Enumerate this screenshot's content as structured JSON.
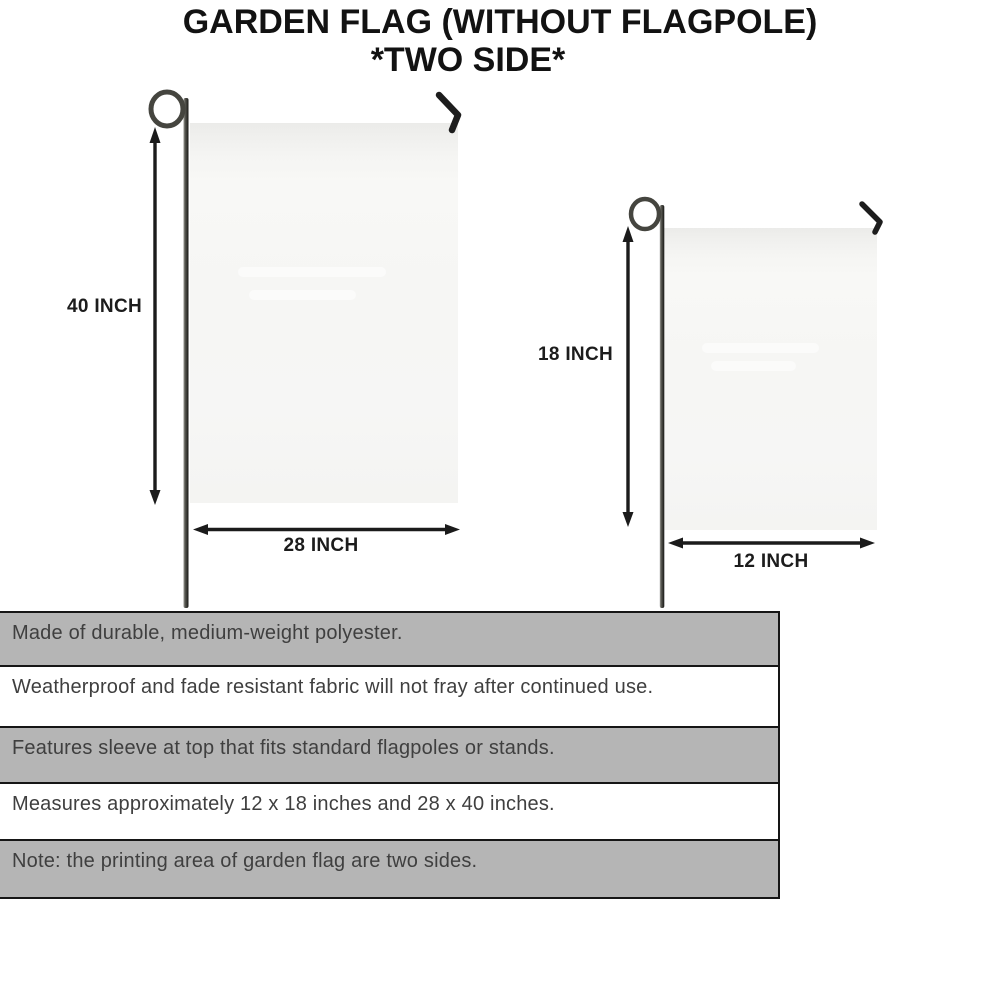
{
  "title": {
    "line1": "GARDEN FLAG (WITHOUT FLAGPOLE)",
    "line2": "*TWO SIDE*"
  },
  "flags": {
    "large": {
      "height_label": "40 INCH",
      "width_label": "28 INCH"
    },
    "small": {
      "height_label": "18 INCH",
      "width_label": "12 INCH"
    }
  },
  "features": {
    "rows": [
      {
        "text": "Made of durable, medium-weight polyester.",
        "shaded": true
      },
      {
        "text": "Weatherproof and fade resistant fabric will not fray after continued use.",
        "shaded": false
      },
      {
        "text": "Features sleeve at top that fits standard flagpoles or stands.",
        "shaded": true
      },
      {
        "text": "Measures approximately 12 x 18 inches and 28 x 40 inches.",
        "shaded": false
      },
      {
        "text": "Note: the printing area of garden flag are two sides.",
        "shaded": true
      }
    ]
  },
  "colors": {
    "background": "#ffffff",
    "ink": "#1b1b1b",
    "title_text": "#121212",
    "table_shaded_row": "#b5b5b5",
    "table_plain_row": "#ffffff",
    "table_border": "#161616",
    "table_text": "#3f3f3f",
    "flag_fill": "#f6f6f4",
    "pole_dark": "#181815",
    "pole_light": "#9a9a94"
  }
}
